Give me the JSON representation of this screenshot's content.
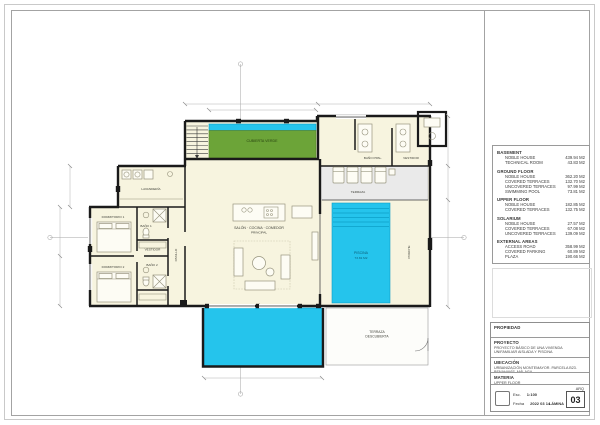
{
  "colors": {
    "wall": "#1a1a1a",
    "floor_cream": "#f7f4df",
    "pool_cyan": "#25c4ec",
    "green_roof": "#6ca438",
    "terrace_gray": "#eaeaea",
    "frame_gray": "#a3a3a3"
  },
  "plan": {
    "labels": {
      "green_roof": "CUBIERTA VERDE",
      "laundry": "LAVANDERÍA",
      "bedroom1": "DORMITORIO 1",
      "bedroom2": "DORMITORIO 2",
      "bath1": "BAÑO 1",
      "dressing1": "VESTIDOR",
      "bath2": "BAÑO 2",
      "corridor": "PASILLO",
      "living1": "SALÓN · COCINA · COMEDOR",
      "living2": "PRINCIPAL",
      "master_bath": "BAÑO PPAL.",
      "dressing2": "VESTIDOR",
      "terrace": "TERRAZA",
      "pool_name": "PISCINA",
      "pool_area": "73.81 M2",
      "bterrace1": "TERRAZA",
      "bterrace2": "DESCUBIERTA",
      "porch": "PORCHE"
    }
  },
  "schedule": {
    "sections": [
      {
        "title": "BASEMENT",
        "rows": [
          {
            "label": "NOBLE HOUSE",
            "value": "439.94 M2"
          },
          {
            "label": "TECHNICAL ROOM",
            "value": "43.83 M2"
          }
        ]
      },
      {
        "title": "GROUND FLOOR",
        "rows": [
          {
            "label": "NOBLE HOUSE",
            "value": "362.20 M2"
          },
          {
            "label": "COVERED TERRACES",
            "value": "132.70 M2"
          },
          {
            "label": "UNCOVERED TERRACES",
            "value": "97.99 M2"
          },
          {
            "label": "SWIMMING POOL",
            "value": "73.81 M2"
          }
        ]
      },
      {
        "title": "UPPER FLOOR",
        "rows": [
          {
            "label": "NOBLE HOUSE",
            "value": "182.85 M2"
          },
          {
            "label": "COVERED TERRACES",
            "value": "132.75 M2"
          }
        ]
      },
      {
        "title": "SOLARIUM",
        "rows": [
          {
            "label": "NOBLE HOUSE",
            "value": "27.57 M2"
          },
          {
            "label": "COVERED TERRACES",
            "value": "67.08 M2"
          },
          {
            "label": "UNCOVERED TERRACES",
            "value": "139.09 M2"
          }
        ]
      },
      {
        "title": "EXTERNAL AREAS",
        "rows": [
          {
            "label": "ACCESS ROAD",
            "value": "358.99 M2"
          },
          {
            "label": "COVERED PARKING",
            "value": "60.89 M2"
          },
          {
            "label": "PLAZA",
            "value": "190.66 M2"
          }
        ]
      }
    ]
  },
  "titleblock": {
    "propiedad_label": "PROPIEDAD",
    "proyecto_label": "PROYECTO",
    "proyecto_text": "PROYECTO BÁSICO DE UNA VIVIENDA UNIFAMILIAR AISLADA Y PISCINA",
    "ubicacion_label": "UBICACIÓN",
    "ubicacion_text": "URBANIZACIÓN MONTEMAYOR. PARCELA B23. BENAHAVÍS. MÁLAGA",
    "materia_label": "MATERIA",
    "materia_text": "UPPER FLOOR",
    "esc_label": "Esc.",
    "esc_value": "1:100",
    "fecha_label": "Fecha",
    "fecha_value": "2022 03 14",
    "arq_label": "ARQ",
    "sheet_number": "03",
    "lamina_label": "LÁMINA"
  }
}
